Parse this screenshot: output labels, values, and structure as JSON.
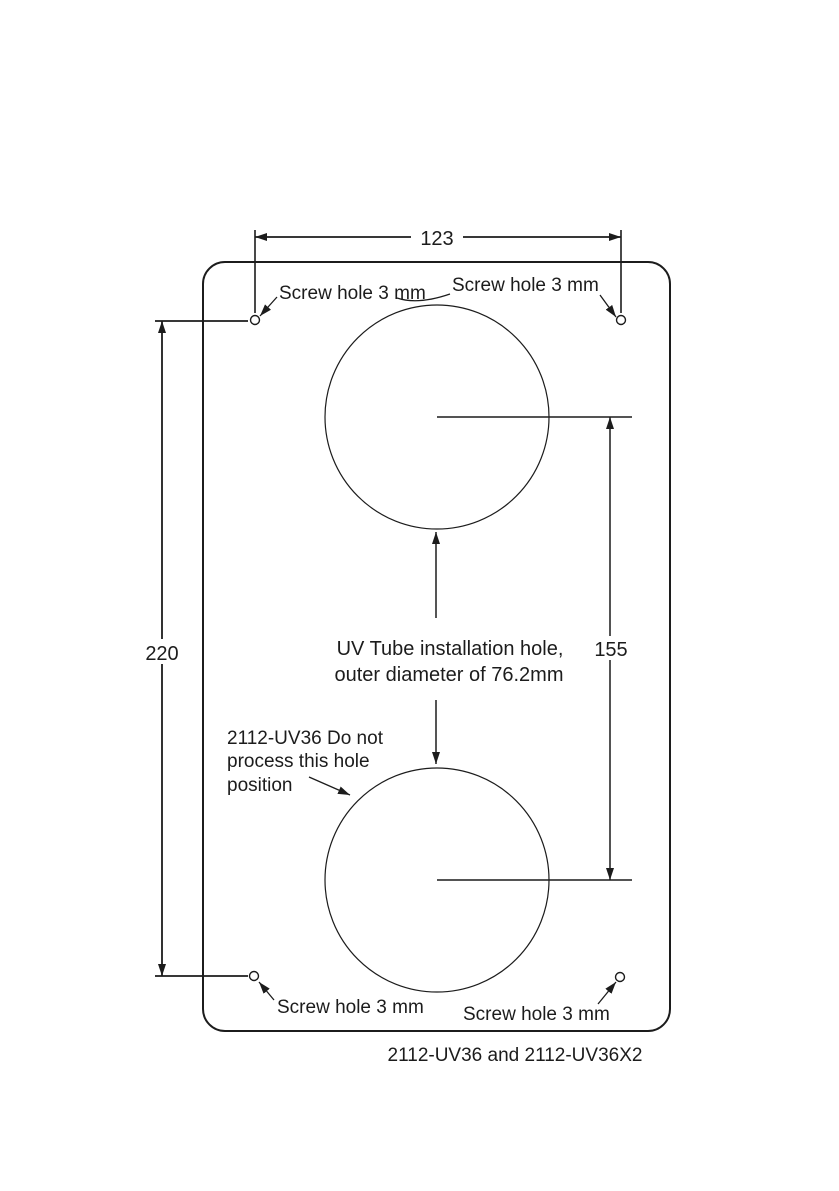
{
  "diagram": {
    "caption": "2112-UV36 and 2112-UV36X2",
    "dimensions": {
      "width": "123",
      "height": "220",
      "hole_center_spacing": "155"
    },
    "screw_hole_labels": {
      "top_left": "Screw hole 3 mm",
      "top_right": "Screw hole 3 mm",
      "bottom_left": "Screw hole 3 mm",
      "bottom_right": "Screw hole 3 mm"
    },
    "uv_hole_note": {
      "line1": "UV Tube installation hole,",
      "line2": "outer diameter of 76.2mm"
    },
    "position_note": {
      "line1": "2112-UV36 Do not",
      "line2": "process this hole",
      "line3": "position"
    },
    "colors": {
      "line": "#1c1c1c",
      "background": "#ffffff"
    }
  }
}
